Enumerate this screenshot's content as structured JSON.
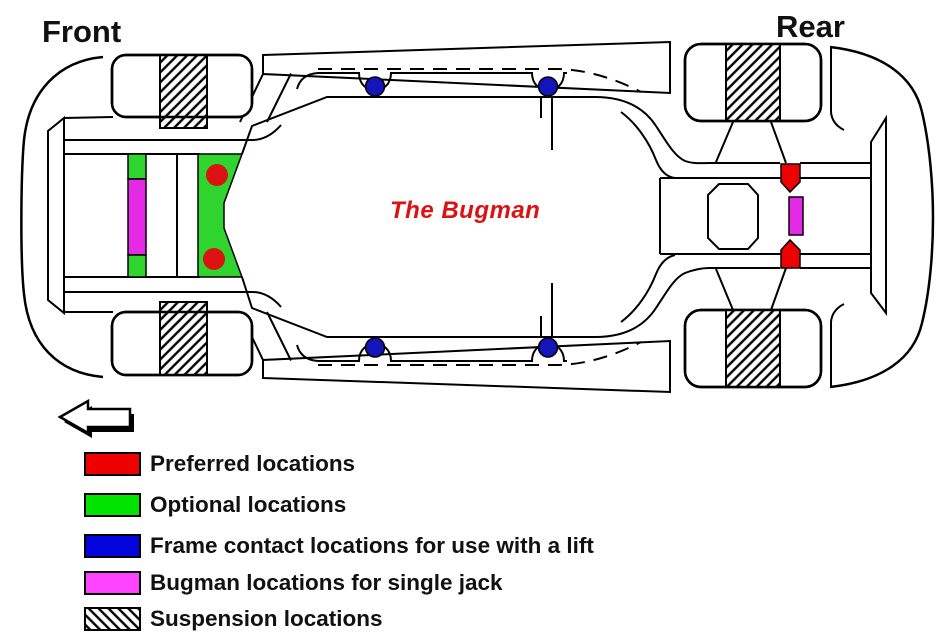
{
  "labels": {
    "front": "Front",
    "rear": "Rear"
  },
  "brand": {
    "text": "The Bugman",
    "color": "#dd1111"
  },
  "colors": {
    "preferred": "#ee0000",
    "preferred_marker": "#dc1111",
    "optional": "#00e400",
    "optional_area": "#2fd42f",
    "lift": "#0404dd",
    "lift_marker": "#1414bb",
    "single_jack": "#ff44ff",
    "single_jack_marker": "#e52ae5",
    "outline": "#000000",
    "background": "#ffffff"
  },
  "legend": {
    "items": [
      {
        "key": "preferred",
        "label": "Preferred locations",
        "color": "#ee0000",
        "style": "solid"
      },
      {
        "key": "optional",
        "label": "Optional locations",
        "color": "#00e400",
        "style": "solid"
      },
      {
        "key": "lift",
        "label": "Frame contact locations for use with a lift",
        "color": "#0404dd",
        "style": "solid"
      },
      {
        "key": "single_jack",
        "label": "Bugman locations for single jack",
        "color": "#ff44ff",
        "style": "solid"
      },
      {
        "key": "suspension",
        "label": "Suspension locations",
        "color": "#ffffff",
        "style": "diagonal-hatch"
      }
    ]
  },
  "diagram": {
    "subject": "car chassis jacking point diagram, viewed from underneath, front at left",
    "front_direction_arrow": "points-left",
    "markers": {
      "preferred_front_circles": 2,
      "preferred_rear_pentagons": 2,
      "lift_contact_circles": 4,
      "single_jack_bars": 2,
      "suspension_hatched_wheel_bands": 4
    }
  }
}
